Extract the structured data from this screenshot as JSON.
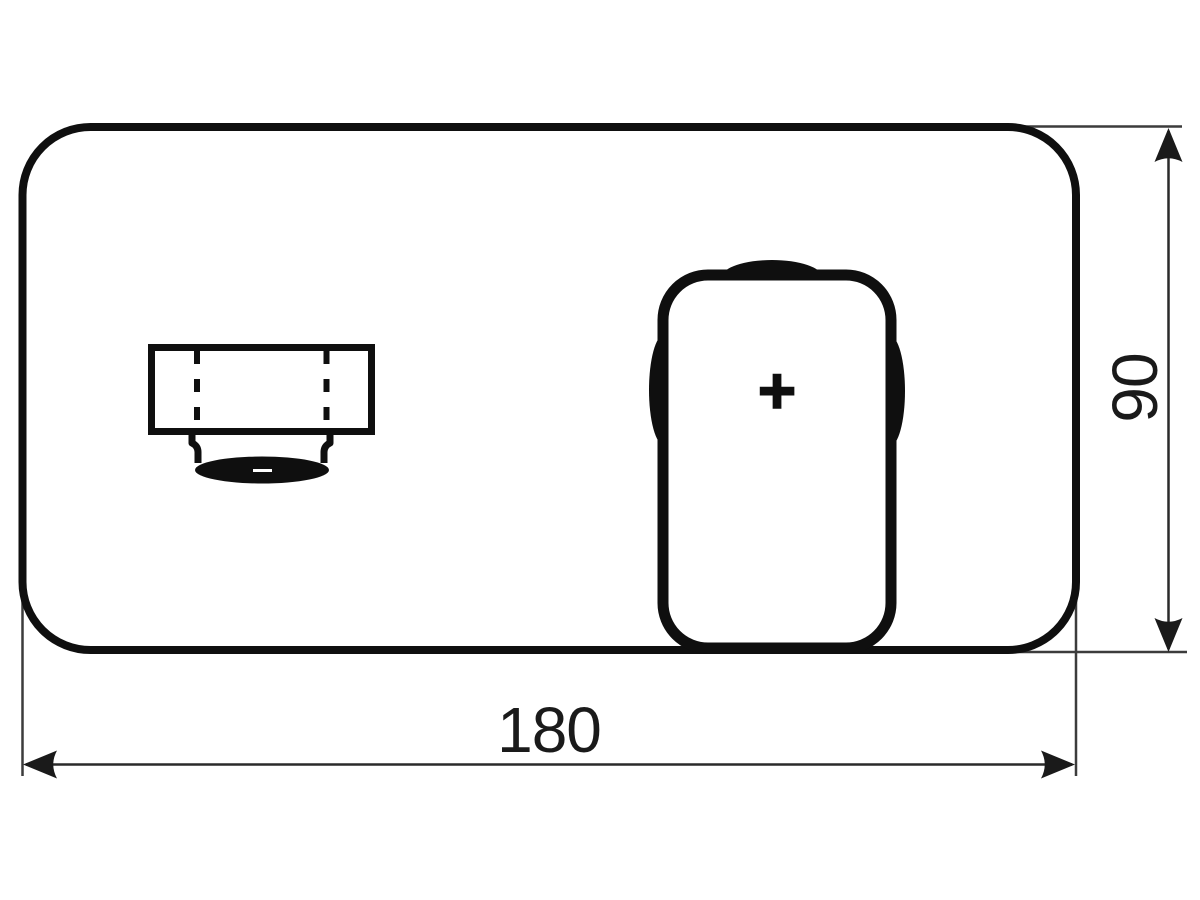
{
  "drawing": {
    "type": "technical-dimension-drawing",
    "subject": "wall-mounted-mixer-faceplate-front-view",
    "background_color": "#ffffff",
    "outline_color": "#0f0f0f",
    "dimension_line_color": "#3c3c3c"
  },
  "dimensions": {
    "width": {
      "label": "180",
      "orientation": "horizontal"
    },
    "height": {
      "label": "90",
      "orientation": "vertical"
    }
  },
  "handle": {
    "marker": "+"
  }
}
